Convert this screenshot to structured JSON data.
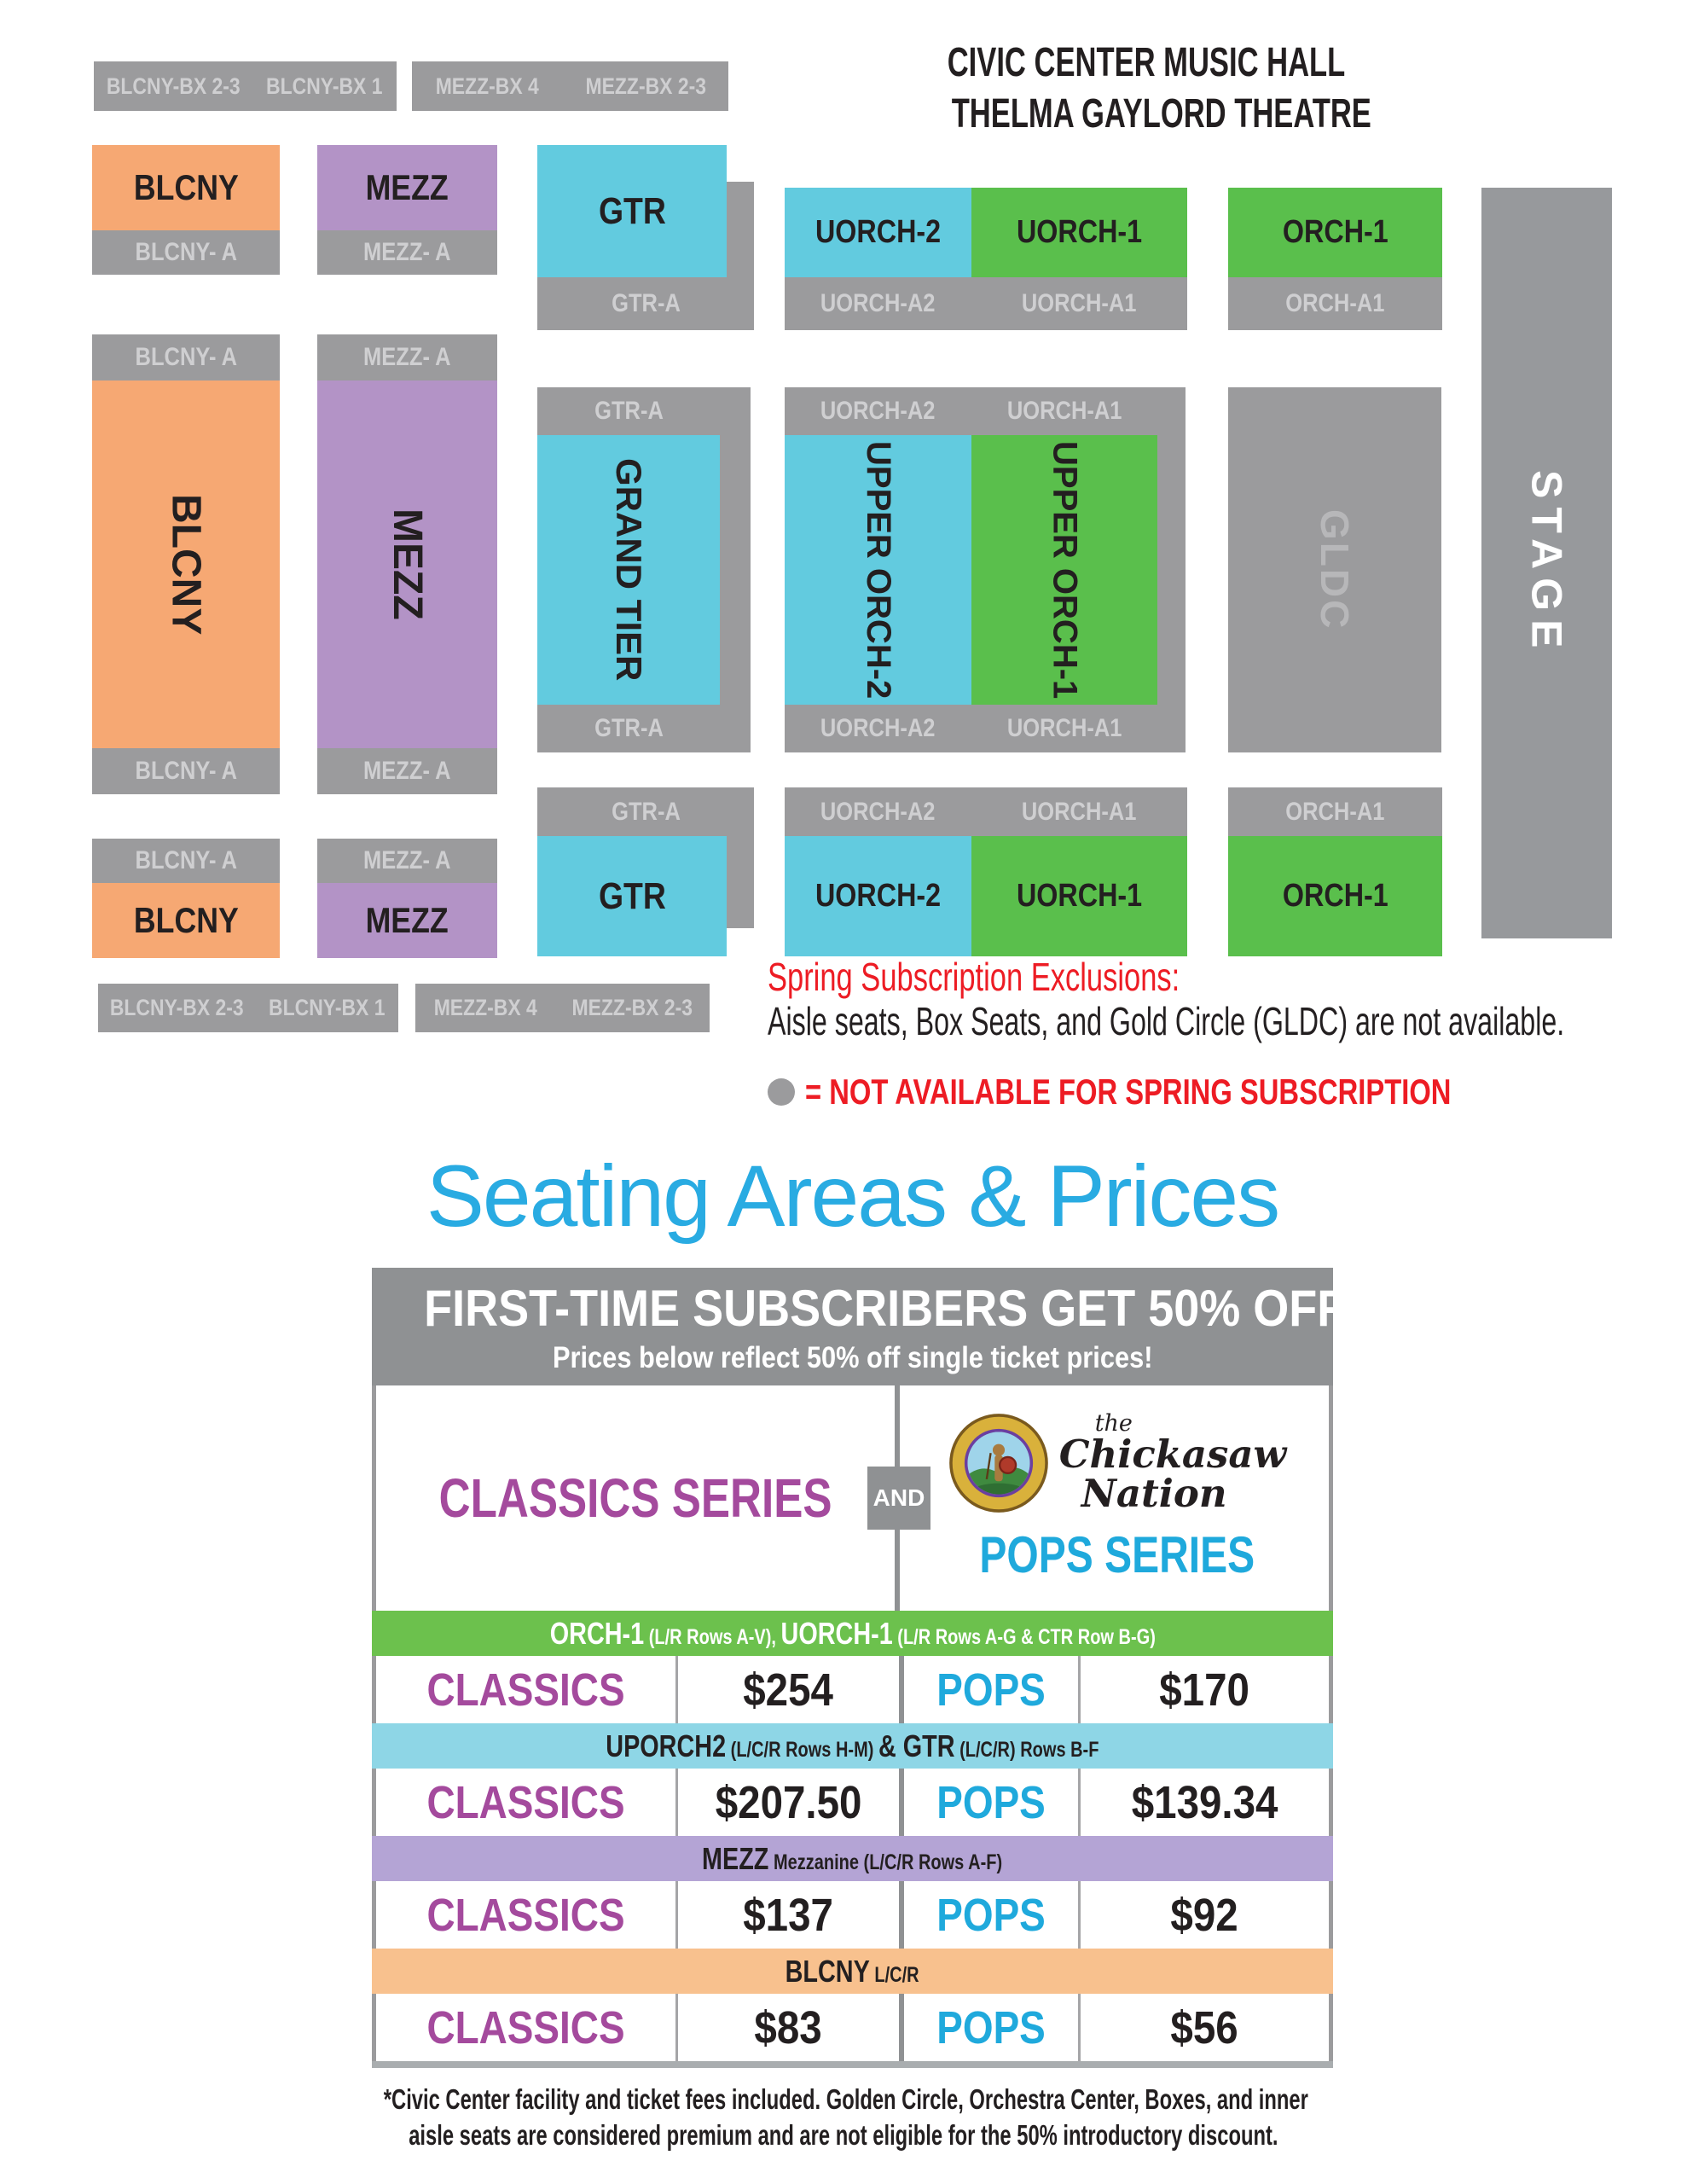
{
  "colors": {
    "block_gray": "#9B9B9D",
    "label_on_gray": "#CFCFD1",
    "orange": "#F6A873",
    "purple": "#B393C6",
    "cyan": "#62CBDF",
    "green": "#5ABF4C",
    "stage_gray": "#97999C",
    "gldc_text": "#B7B7B9",
    "red": "#ED1C24",
    "title_cyan": "#29ABE2",
    "classics_purple": "#A44A9D",
    "pops_cyan": "#1FA9DC",
    "band_green": "#6CC14D",
    "band_cyan": "#8ED6E6",
    "band_purple": "#B4A4D5",
    "band_orange": "#F8C18E",
    "header_gray": "#8F9193",
    "text_dark": "#231F20"
  },
  "venue": {
    "line1": "CIVIC CENTER MUSIC HALL",
    "line2": "THELMA GAYLORD THEATRE"
  },
  "map": {
    "blcny_bx23": "BLCNY-BX 2-3",
    "blcny_bx1": "BLCNY-BX 1",
    "mezz_bx4": "MEZZ-BX 4",
    "mezz_bx23": "MEZZ-BX 2-3",
    "blcny": "BLCNY",
    "blcny_a": "BLCNY- A",
    "mezz": "MEZZ",
    "mezz_a": "MEZZ- A",
    "gtr": "GTR",
    "gtr_a": "GTR-A",
    "grand_tier": "GRAND TIER",
    "uorch2": "UORCH-2",
    "uorch1": "UORCH-1",
    "uorch_a2": "UORCH-A2",
    "uorch_a1": "UORCH-A1",
    "upper_orch2": "UPPER ORCH-2",
    "upper_orch1": "UPPER ORCH-1",
    "orch1": "ORCH-1",
    "orch_a1": "ORCH-A1",
    "gldc": "GLDC",
    "stage": "STAGE"
  },
  "exclusions": {
    "heading": "Spring Subscription Exclusions:",
    "body": "Aisle seats, Box Seats, and Gold Circle (GLDC) are not available.",
    "legend": "= NOT AVAILABLE FOR SPRING SUBSCRIPTION"
  },
  "pricing": {
    "title": "Seating Areas & Prices",
    "banner_line1": "FIRST-TIME SUBSCRIBERS GET 50% OFF*",
    "banner_line2": "Prices below reflect 50% off single ticket prices!",
    "classics_series": "CLASSICS SERIES",
    "and": "AND",
    "pops_series": "POPS SERIES",
    "logo": {
      "the": "the",
      "chickasaw": "Chickasaw",
      "nation": "Nation"
    },
    "rows": [
      {
        "band_bold1": "ORCH-1",
        "band_small1": " (L/R Rows A-V), ",
        "band_bold2": "UORCH-1",
        "band_small2": " (L/R Rows A-G & CTR Row B-G)",
        "classics": "CLASSICS",
        "classics_price": "$254",
        "pops": "POPS",
        "pops_price": "$170"
      },
      {
        "band_bold1": "UPORCH2",
        "band_small1": " (L/C/R Rows H-M) ",
        "band_bold2": "& GTR",
        "band_small2": " (L/C/R) Rows B-F",
        "classics": "CLASSICS",
        "classics_price": "$207.50",
        "pops": "POPS",
        "pops_price": "$139.34"
      },
      {
        "band_bold1": "MEZZ",
        "band_small1": " Mezzanine (L/C/R Rows A-F)",
        "band_bold2": "",
        "band_small2": "",
        "classics": "CLASSICS",
        "classics_price": "$137",
        "pops": "POPS",
        "pops_price": "$92"
      },
      {
        "band_bold1": "BLCNY",
        "band_small1": " L/C/R",
        "band_bold2": "",
        "band_small2": "",
        "classics": "CLASSICS",
        "classics_price": "$83",
        "pops": "POPS",
        "pops_price": "$56"
      }
    ]
  },
  "footnote": {
    "line1": "*Civic Center facility and ticket fees included. Golden Circle, Orchestra Center, Boxes, and inner",
    "line2": "aisle seats are considered premium and are not eligible for the 50% introductory discount."
  }
}
